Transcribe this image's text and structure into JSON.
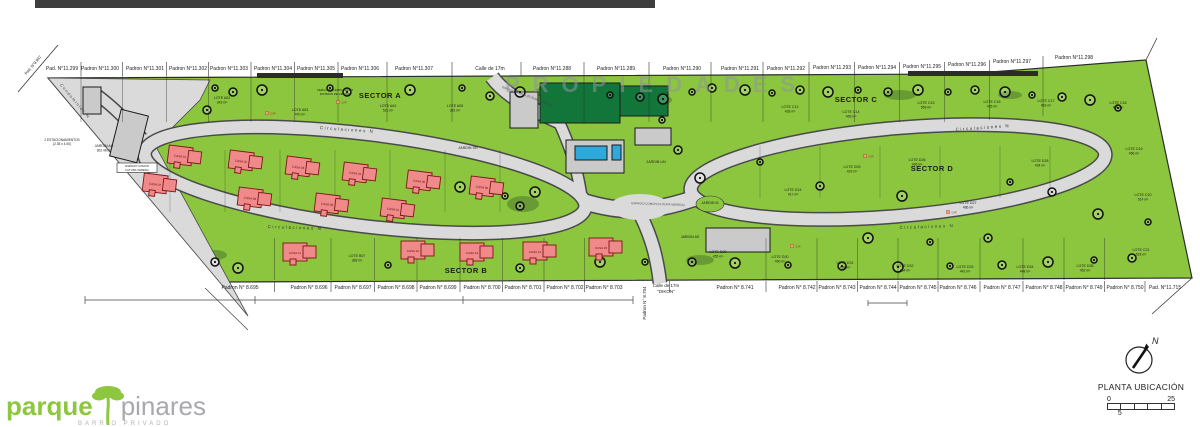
{
  "plan": {
    "watermark": "PROPIEDADES",
    "road_label": "Circulaciones N",
    "road_label_positions": [
      [
        347,
        131,
        4
      ],
      [
        295,
        229,
        2
      ],
      [
        983,
        129,
        -4
      ],
      [
        927,
        228,
        -2
      ]
    ],
    "left_street": {
      "t": "Condominios N",
      "x": 74,
      "y": 102,
      "rot": 50
    },
    "corner_pad": {
      "t": "Pad. N°9.947",
      "x": 34,
      "y": 66,
      "rot": -50
    },
    "espacio_comun": {
      "t": "ESPACIO COMUN (FUTURA VEREDA)",
      "positions": [
        [
          527,
          97,
          20
        ],
        [
          658,
          205,
          2
        ]
      ]
    },
    "espacio_box": {
      "l1": "ESPACIO COMUN",
      "l2": "FUTURA VEREDA",
      "x": 137,
      "y": 167
    },
    "parking_note": {
      "l1": "2 ESTACIONAMIENTOS",
      "l2": "(2.35 x 4.50)",
      "x": 62,
      "y": 141
    },
    "cerco_note": {
      "l1": "CERCO S/M EMPLAZADO",
      "l2": "DIVISION DE VECINO",
      "x": 335,
      "y": 91
    },
    "cap_label": "CAP",
    "top_padrons": [
      {
        "t": "Pad. N°11.299",
        "x": 62,
        "y": 70
      },
      {
        "t": "Padron N°11.300",
        "x": 100,
        "y": 70
      },
      {
        "t": "Padron N°11.301",
        "x": 145,
        "y": 70
      },
      {
        "t": "Padron N°11.302",
        "x": 188,
        "y": 70
      },
      {
        "t": "Padron N°11.303",
        "x": 229,
        "y": 70
      },
      {
        "t": "Padron N°11.304",
        "x": 273,
        "y": 70
      },
      {
        "t": "Padron N°11.305",
        "x": 316,
        "y": 70
      },
      {
        "t": "Padron N°11.306",
        "x": 360,
        "y": 70
      },
      {
        "t": "Padron N°11.307",
        "x": 414,
        "y": 70
      },
      {
        "t": "Calle de 17m",
        "x": 490,
        "y": 70
      },
      {
        "t": "Padron N°11.288",
        "x": 552,
        "y": 70
      },
      {
        "t": "Padron N°11.289",
        "x": 616,
        "y": 70
      },
      {
        "t": "Padron N°11.290",
        "x": 682,
        "y": 70
      },
      {
        "t": "Padron N°11.291",
        "x": 740,
        "y": 70
      },
      {
        "t": "Padron N°11.292",
        "x": 786,
        "y": 70
      },
      {
        "t": "Padron N°11.293",
        "x": 832,
        "y": 69
      },
      {
        "t": "Padron N°11.294",
        "x": 877,
        "y": 69
      },
      {
        "t": "Padron N°11.295",
        "x": 922,
        "y": 68
      },
      {
        "t": "Padron N°11.296",
        "x": 967,
        "y": 66
      },
      {
        "t": "Padron N°11.297",
        "x": 1012,
        "y": 63
      },
      {
        "t": "Padron N°11.298",
        "x": 1074,
        "y": 59
      }
    ],
    "bottom_padrons": [
      {
        "t": "Padron N° 8.695",
        "x": 240
      },
      {
        "t": "Padron N° 8.696",
        "x": 309
      },
      {
        "t": "Padron N° 8.697",
        "x": 353
      },
      {
        "t": "Padron N° 8.698",
        "x": 396
      },
      {
        "t": "Padron N° 8.699",
        "x": 438
      },
      {
        "t": "Padron N° 8.700",
        "x": 482
      },
      {
        "t": "Padron N° 8.701",
        "x": 523
      },
      {
        "t": "Padron N° 8.702",
        "x": 565
      },
      {
        "t": "Padron N° 8.703",
        "x": 604
      },
      {
        "t": "Padron N° 8.741",
        "x": 735
      },
      {
        "t": "Padron N° 8.742",
        "x": 797
      },
      {
        "t": "Padron N° 8.743",
        "x": 837
      },
      {
        "t": "Padron N° 8.744",
        "x": 878
      },
      {
        "t": "Padron N° 8.745",
        "x": 918
      },
      {
        "t": "Padron N° 8.746",
        "x": 958
      },
      {
        "t": "Padron N° 8.747",
        "x": 1002
      },
      {
        "t": "Padron N° 8.748",
        "x": 1044
      },
      {
        "t": "Padron N° 8.749",
        "x": 1084
      },
      {
        "t": "Padron N° 8.750",
        "x": 1125
      },
      {
        "t": "Pad. N°11.715",
        "x": 1165
      }
    ],
    "vertical_padron": {
      "t": "Padron N° 8.704",
      "x": 646,
      "y": 303
    },
    "calle_bottom": {
      "l1": "Calle de 17m",
      "l2": "\"DIKON\"",
      "x": 666,
      "y": 287
    },
    "sectors": [
      {
        "name": "SECTOR A",
        "x": 380,
        "y": 98
      },
      {
        "name": "SECTOR B",
        "x": 466,
        "y": 273
      },
      {
        "name": "SECTOR C",
        "x": 856,
        "y": 102
      },
      {
        "name": "SECTOR D",
        "x": 932,
        "y": 171
      }
    ],
    "lots": [
      {
        "id": "LOTE A02",
        "area": "343 m²",
        "x": 222,
        "y": 99
      },
      {
        "id": "LOTE A03",
        "area": "470 m²",
        "x": 300,
        "y": 111
      },
      {
        "id": "LOTE A04",
        "area": "521 m²",
        "x": 388,
        "y": 107
      },
      {
        "id": "LOTE A05",
        "area": "381 m²",
        "x": 455,
        "y": 107
      },
      {
        "id": "LOTE B07",
        "area": "383 m²",
        "x": 357,
        "y": 257
      },
      {
        "id": "LOTE C12",
        "area": "428 m²",
        "x": 790,
        "y": 108
      },
      {
        "id": "LOTE C14",
        "area": "469 m²",
        "x": 851,
        "y": 113
      },
      {
        "id": "LOTE C15",
        "area": "559 m²",
        "x": 926,
        "y": 104
      },
      {
        "id": "LOTE C16",
        "area": "435 m²",
        "x": 992,
        "y": 103
      },
      {
        "id": "LOTE C17",
        "area": "453 m²",
        "x": 1046,
        "y": 102
      },
      {
        "id": "LOTE C18",
        "area": "480 m²",
        "x": 1118,
        "y": 104
      },
      {
        "id": "LOTE C19",
        "area": "456 m²",
        "x": 1134,
        "y": 150
      },
      {
        "id": "LOTE C20",
        "area": "514 m²",
        "x": 1143,
        "y": 196
      },
      {
        "id": "LOTE C21",
        "area": "518 m²",
        "x": 1141,
        "y": 251
      },
      {
        "id": "LOTE D24",
        "area": "417 m²",
        "x": 793,
        "y": 191
      },
      {
        "id": "LOTE D25",
        "area": "423 m²",
        "x": 852,
        "y": 168
      },
      {
        "id": "LOTE D26",
        "area": "436 m²",
        "x": 917,
        "y": 161
      },
      {
        "id": "LOTE D27",
        "area": "486 m²",
        "x": 968,
        "y": 204
      },
      {
        "id": "LOTE D28",
        "area": "434 m²",
        "x": 1040,
        "y": 162
      },
      {
        "id": "LOTE D29",
        "area": "455 m²",
        "x": 718,
        "y": 253
      },
      {
        "id": "LOTE D30",
        "area": "490 m²",
        "x": 780,
        "y": 258
      },
      {
        "id": "LOTE D31",
        "area": "438 m²",
        "x": 845,
        "y": 264
      },
      {
        "id": "LOTE D32",
        "area": "464 m²",
        "x": 905,
        "y": 267
      },
      {
        "id": "LOTE D33",
        "area": "442 m²",
        "x": 965,
        "y": 268
      },
      {
        "id": "LOTE D34",
        "area": "448 m²",
        "x": 1025,
        "y": 268
      },
      {
        "id": "LOTE D35",
        "area": "452 m²",
        "x": 1085,
        "y": 267
      }
    ],
    "gardens": [
      {
        "t": "JARDIN AC",
        "a": "302.46 m²",
        "x": 104,
        "y": 147
      },
      {
        "t": "JARDIN SH",
        "a": "",
        "x": 468,
        "y": 149
      },
      {
        "t": "JARDIN UN",
        "a": "",
        "x": 656,
        "y": 163
      },
      {
        "t": "JARDIN M",
        "a": "",
        "x": 710,
        "y": 204
      },
      {
        "t": "JARDIN AS",
        "a": "",
        "x": 690,
        "y": 238
      }
    ],
    "houses": [
      {
        "id": "CASA 01",
        "x": 185,
        "y": 157,
        "rot": 7
      },
      {
        "id": "CASA 02",
        "x": 246,
        "y": 162,
        "rot": 7
      },
      {
        "id": "CASA 03",
        "x": 303,
        "y": 168,
        "rot": 7
      },
      {
        "id": "CASA 04",
        "x": 360,
        "y": 174,
        "rot": 7
      },
      {
        "id": "CASA 05",
        "x": 424,
        "y": 182,
        "rot": 7
      },
      {
        "id": "CASA 06",
        "x": 487,
        "y": 188,
        "rot": 7
      },
      {
        "id": "CASA 07",
        "x": 160,
        "y": 185,
        "rot": 7
      },
      {
        "id": "CASA 08",
        "x": 255,
        "y": 199,
        "rot": 7
      },
      {
        "id": "CASA 09",
        "x": 332,
        "y": 205,
        "rot": 7
      },
      {
        "id": "CASA 10",
        "x": 398,
        "y": 210,
        "rot": 7
      },
      {
        "id": "CASA 11",
        "x": 300,
        "y": 253,
        "rot": 0
      },
      {
        "id": "CASA 12",
        "x": 418,
        "y": 251,
        "rot": 0
      },
      {
        "id": "CASA 13",
        "x": 477,
        "y": 253,
        "rot": 0
      },
      {
        "id": "CASA 14",
        "x": 540,
        "y": 252,
        "rot": 0
      },
      {
        "id": "CASA 15",
        "x": 606,
        "y": 248,
        "rot": 0
      }
    ],
    "trees": [
      [
        215,
        88
      ],
      [
        233,
        92
      ],
      [
        262,
        90
      ],
      [
        330,
        88
      ],
      [
        347,
        92
      ],
      [
        410,
        90
      ],
      [
        462,
        88
      ],
      [
        490,
        96
      ],
      [
        520,
        92
      ],
      [
        610,
        95
      ],
      [
        640,
        97
      ],
      [
        663,
        99
      ],
      [
        692,
        92
      ],
      [
        712,
        88
      ],
      [
        745,
        90
      ],
      [
        772,
        93
      ],
      [
        800,
        90
      ],
      [
        828,
        92
      ],
      [
        858,
        90
      ],
      [
        888,
        92
      ],
      [
        918,
        90
      ],
      [
        948,
        92
      ],
      [
        975,
        90
      ],
      [
        1005,
        92
      ],
      [
        1032,
        95
      ],
      [
        1062,
        97
      ],
      [
        1090,
        100
      ],
      [
        1118,
        108
      ],
      [
        207,
        110
      ],
      [
        460,
        187
      ],
      [
        505,
        196
      ],
      [
        520,
        206
      ],
      [
        535,
        192
      ],
      [
        662,
        120
      ],
      [
        678,
        150
      ],
      [
        700,
        178
      ],
      [
        760,
        162
      ],
      [
        820,
        186
      ],
      [
        902,
        196
      ],
      [
        1010,
        182
      ],
      [
        1052,
        192
      ],
      [
        1098,
        214
      ],
      [
        1148,
        222
      ],
      [
        215,
        262
      ],
      [
        238,
        268
      ],
      [
        388,
        265
      ],
      [
        520,
        268
      ],
      [
        600,
        262
      ],
      [
        645,
        262
      ],
      [
        692,
        262
      ],
      [
        735,
        263
      ],
      [
        788,
        265
      ],
      [
        842,
        266
      ],
      [
        898,
        267
      ],
      [
        950,
        266
      ],
      [
        1002,
        265
      ],
      [
        1048,
        262
      ],
      [
        1094,
        260
      ],
      [
        1132,
        258
      ],
      [
        868,
        238
      ],
      [
        930,
        242
      ],
      [
        988,
        238
      ]
    ],
    "shrubs": [
      [
        523,
        204,
        16,
        8
      ],
      [
        610,
        93,
        14,
        6
      ],
      [
        660,
        100,
        12,
        5
      ],
      [
        215,
        255,
        12,
        5
      ],
      [
        545,
        92,
        10,
        5
      ],
      [
        700,
        260,
        14,
        5
      ],
      [
        900,
        95,
        16,
        5
      ],
      [
        1010,
        95,
        12,
        4
      ]
    ],
    "caps": [
      [
        338,
        102
      ],
      [
        267,
        113
      ],
      [
        865,
        156
      ],
      [
        948,
        212
      ],
      [
        792,
        246
      ]
    ],
    "legend": {
      "north": "N",
      "title": "PLANTA UBICACIÓN",
      "zero": "0",
      "max": "25",
      "mid": "5"
    },
    "logo": {
      "p1": "parque",
      "p2": "pinares",
      "sub": "BARRIO PRIVADO"
    },
    "colors": {
      "green": "#8cc63e",
      "dark_green": "#12763a",
      "road": "#d9dad9",
      "road_edge": "#4a4a4a",
      "house": "#f0898a",
      "house_edge": "#7d1616",
      "pool": "#2fa8dc",
      "gray_bldg": "#c9cac9",
      "logo_green": "#8dc63f",
      "logo_gray": "#a7a9ac"
    }
  }
}
